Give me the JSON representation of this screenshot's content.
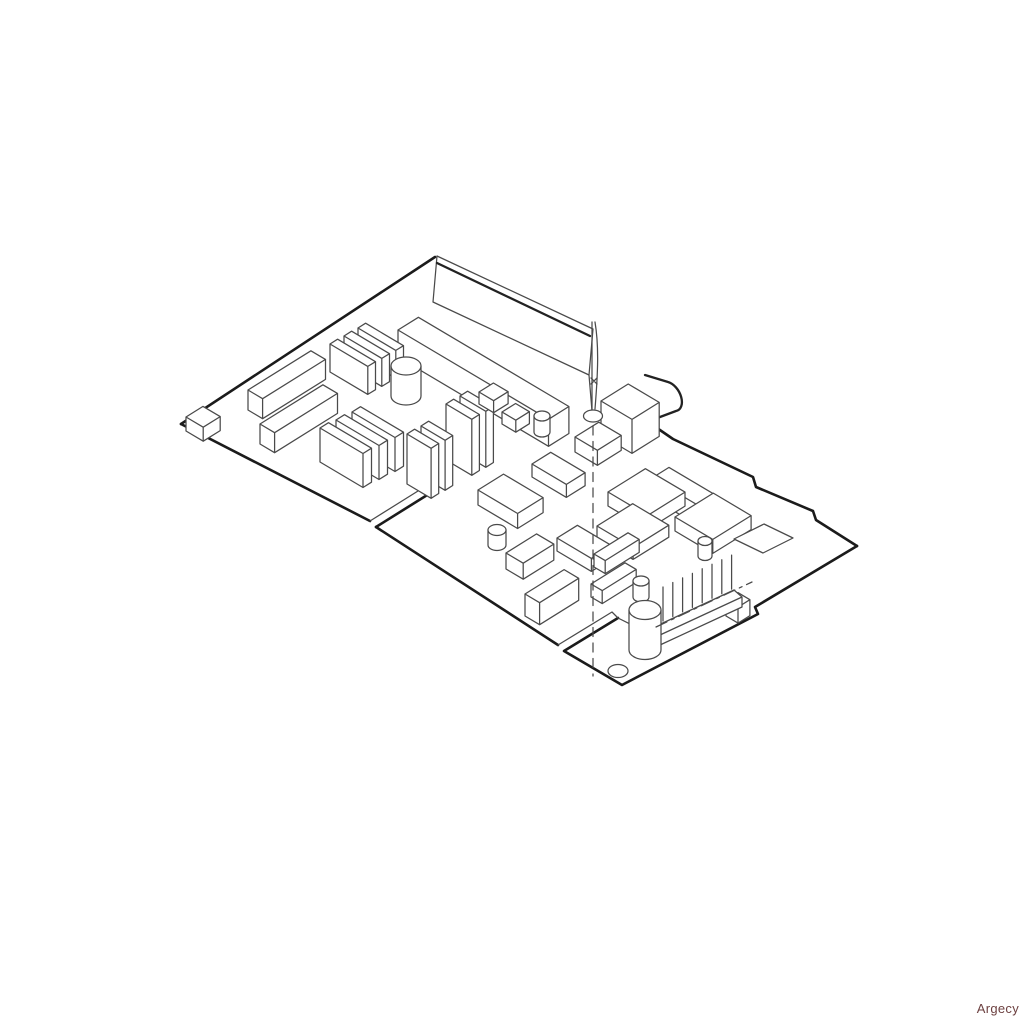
{
  "page": {
    "background": "#ffffff"
  },
  "watermark": {
    "text": "Argecy",
    "color": "#6d4141"
  },
  "diagram": {
    "description": "isometric-line-drawing-of-printer-controller-board",
    "stroke": {
      "bold": "#1b1b1b",
      "medium": "#222222",
      "thin": "#4a4a4a",
      "bold_width": 2.6,
      "medium_width": 2.3,
      "thin_width": 1.25
    },
    "fill": "#ffffff",
    "iso_axes": {
      "a": [
        0.85,
        -0.53
      ],
      "b": [
        0.86,
        0.51
      ]
    },
    "elements": [
      {
        "t": "p",
        "n": "bracket-plate",
        "d": "M437,256 L593,329 L589,375 L433,302 Z",
        "w": "T",
        "f": "W"
      },
      {
        "t": "p",
        "n": "bracket-plate-fold-edge",
        "d": "M437,263 L590,336",
        "w": "M",
        "f": "N"
      },
      {
        "t": "l",
        "n": "bracket-plate-right-edge",
        "x1": 589,
        "y1": 375,
        "x2": 592,
        "y2": 411,
        "w": "T"
      },
      {
        "t": "b",
        "n": "rear-connector",
        "x": 398,
        "y": 330,
        "la": 24,
        "lb": 175,
        "h": 27
      },
      {
        "t": "p",
        "n": "board-edge-top-left",
        "d": "M181,424 L435,257",
        "w": "B",
        "f": "N"
      },
      {
        "t": "p",
        "n": "board-edge-top-right",
        "d": "M657,428 L673,439 L753,477 L756,487 L813,511 L816,520 L857,546",
        "w": "B",
        "f": "N"
      },
      {
        "t": "p",
        "n": "board-edge-bottom-right-and-tab",
        "d": "M857,546 L755,607 L758,614 L622,685 L564,651 L618,618",
        "w": "B",
        "f": "N"
      },
      {
        "t": "p",
        "n": "board-edge-bottom-left-a",
        "d": "M181,424 L370,521",
        "w": "B",
        "f": "N"
      },
      {
        "t": "p",
        "n": "slot1-inner-edge",
        "d": "M370,521 L426,486 L432,492",
        "w": "T",
        "f": "N"
      },
      {
        "t": "p",
        "n": "slot1-outer-edge",
        "d": "M376,527 L432,492",
        "w": "B",
        "f": "N"
      },
      {
        "t": "p",
        "n": "board-edge-bottom-left-b",
        "d": "M376,527 L558,645",
        "w": "B",
        "f": "N"
      },
      {
        "t": "p",
        "n": "slot2-inner-edge",
        "d": "M558,645 L612,612 L618,618",
        "w": "T",
        "f": "N"
      },
      {
        "t": "p",
        "n": "board-inner-edge",
        "d": "M618,618 L650,634",
        "w": "T",
        "f": "N"
      },
      {
        "t": "b",
        "n": "corner-chip",
        "x": 186,
        "y": 417,
        "la": 20,
        "lb": 20,
        "h": 14
      },
      {
        "t": "b",
        "n": "ic-soic-1",
        "x": 248,
        "y": 390,
        "la": 74,
        "lb": 17,
        "h": 20
      },
      {
        "t": "b",
        "n": "ic-soic-2",
        "x": 260,
        "y": 424,
        "la": 74,
        "lb": 17,
        "h": 20
      },
      {
        "t": "b",
        "n": "module-plate-3",
        "x": 358,
        "y": 328,
        "la": 9,
        "lb": 44,
        "h": 28
      },
      {
        "t": "b",
        "n": "module-plate-2",
        "x": 344,
        "y": 336,
        "la": 9,
        "lb": 44,
        "h": 28
      },
      {
        "t": "b",
        "n": "module-plate-1",
        "x": 330,
        "y": 344,
        "la": 9,
        "lb": 44,
        "h": 28
      },
      {
        "t": "c",
        "n": "capacitor-1",
        "cx": 406,
        "cy": 366,
        "rx": 15,
        "ry": 9,
        "h": 30
      },
      {
        "t": "b",
        "n": "module-plate-6",
        "x": 352,
        "y": 412,
        "la": 10,
        "lb": 50,
        "h": 34
      },
      {
        "t": "b",
        "n": "module-plate-5",
        "x": 336,
        "y": 420,
        "la": 10,
        "lb": 50,
        "h": 34
      },
      {
        "t": "b",
        "n": "module-plate-4",
        "x": 320,
        "y": 428,
        "la": 10,
        "lb": 50,
        "h": 34
      },
      {
        "t": "b",
        "n": "vert-module-4",
        "x": 460,
        "y": 396,
        "la": 9,
        "lb": 30,
        "h": 56
      },
      {
        "t": "b",
        "n": "vert-module-3",
        "x": 446,
        "y": 404,
        "la": 9,
        "lb": 30,
        "h": 56
      },
      {
        "t": "b",
        "n": "chip-cube-2",
        "x": 479,
        "y": 392,
        "la": 17,
        "lb": 17,
        "h": 12
      },
      {
        "t": "b",
        "n": "vert-module-2",
        "x": 421,
        "y": 426,
        "la": 9,
        "lb": 28,
        "h": 50
      },
      {
        "t": "b",
        "n": "vert-module-1",
        "x": 407,
        "y": 434,
        "la": 9,
        "lb": 28,
        "h": 50
      },
      {
        "t": "b",
        "n": "chip-cube-3",
        "x": 502,
        "y": 412,
        "la": 16,
        "lb": 16,
        "h": 12
      },
      {
        "t": "c",
        "n": "capacitor-2",
        "cx": 542,
        "cy": 416,
        "rx": 8,
        "ry": 5,
        "h": 16
      },
      {
        "t": "p",
        "n": "power-jack-barrel",
        "d": "M645,375 L668,382 A10,16 -30 0 1 676,411 L652,420",
        "w": "M",
        "f": "W"
      },
      {
        "t": "b",
        "n": "power-jack-body",
        "x": 601,
        "y": 401,
        "la": 32,
        "lb": 36,
        "h": 34
      },
      {
        "t": "b",
        "n": "ic-chip-a",
        "x": 575,
        "y": 437,
        "la": 28,
        "lb": 26,
        "h": 15
      },
      {
        "t": "b",
        "n": "ic-chip-b",
        "x": 532,
        "y": 464,
        "la": 22,
        "lb": 40,
        "h": 13
      },
      {
        "t": "b",
        "n": "io-connector",
        "x": 652,
        "y": 478,
        "la": 20,
        "lb": 88,
        "h": 20
      },
      {
        "t": "b",
        "n": "ic-chip-g",
        "x": 608,
        "y": 492,
        "la": 44,
        "lb": 46,
        "h": 14
      },
      {
        "t": "b",
        "n": "ic-chip-i",
        "x": 675,
        "y": 517,
        "la": 45,
        "lb": 44,
        "h": 14
      },
      {
        "t": "b",
        "n": "ic-chip-h",
        "x": 597,
        "y": 526,
        "la": 42,
        "lb": 42,
        "h": 12
      },
      {
        "t": "p",
        "n": "pad-outline",
        "d": "M734,539 L764,524 L793,538 L763,553 Z",
        "w": "T",
        "f": "W"
      },
      {
        "t": "c",
        "n": "capacitor-3",
        "cx": 705,
        "cy": 541,
        "rx": 7,
        "ry": 4.5,
        "h": 15
      },
      {
        "t": "b",
        "n": "ic-chip-c",
        "x": 478,
        "y": 490,
        "la": 30,
        "lb": 46,
        "h": 15
      },
      {
        "t": "b",
        "n": "ic-chip-d",
        "x": 557,
        "y": 538,
        "la": 24,
        "lb": 40,
        "h": 13
      },
      {
        "t": "c",
        "n": "capacitor-4",
        "cx": 497,
        "cy": 530,
        "rx": 9,
        "ry": 5.5,
        "h": 15
      },
      {
        "t": "b",
        "n": "ic-box-f",
        "x": 506,
        "y": 553,
        "la": 36,
        "lb": 20,
        "h": 16
      },
      {
        "t": "b",
        "n": "ic-box-m",
        "x": 525,
        "y": 594,
        "la": 46,
        "lb": 17,
        "h": 22
      },
      {
        "t": "b",
        "n": "ic-box-j",
        "x": 594,
        "y": 554,
        "la": 40,
        "lb": 13,
        "h": 13
      },
      {
        "t": "b",
        "n": "ic-box-k",
        "x": 591,
        "y": 584,
        "la": 40,
        "lb": 13,
        "h": 13
      },
      {
        "t": "c",
        "n": "capacitor-5",
        "cx": 641,
        "cy": 581,
        "rx": 8,
        "ry": 5,
        "h": 16
      },
      {
        "t": "b",
        "n": "header-end-block",
        "x": 726,
        "y": 600,
        "la": 14,
        "lb": 14,
        "h": 16
      },
      {
        "t": "pins",
        "n": "header-pins",
        "x": 663,
        "y": 621,
        "dx": 9.8,
        "dy": -4.55,
        "nn": 8,
        "len": 34
      },
      {
        "t": "p",
        "n": "header-base",
        "d": "M652,628 L734,590 L742,597 L742,607 L660,645 L652,637 Z M660,635 L742,597",
        "w": "T",
        "f": "W"
      },
      {
        "t": "c",
        "n": "capacitor-big",
        "cx": 645,
        "cy": 610,
        "rx": 16,
        "ry": 9.5,
        "h": 40
      },
      {
        "t": "l",
        "n": "header-centerline",
        "x1": 656,
        "y1": 627,
        "x2": 752,
        "y2": 582,
        "w": "T",
        "da": "12 5 3 5"
      },
      {
        "t": "l",
        "n": "screw-shaft-left",
        "x1": 592,
        "y1": 322,
        "x2": 592,
        "y2": 411,
        "w": "T"
      },
      {
        "t": "p",
        "n": "screw-shaft-right",
        "d": "M595,322 C599,346 598,372 595,409",
        "w": "T",
        "f": "N"
      },
      {
        "t": "p",
        "n": "screw-tip-mark",
        "d": "M591,378 L597,384 M597,378 L591,384",
        "w": "T",
        "f": "N"
      },
      {
        "t": "e",
        "n": "standoff-hole",
        "cx": 593,
        "cy": 416,
        "rx": 9.5,
        "ry": 6
      },
      {
        "t": "e",
        "n": "mounting-hole",
        "cx": 618,
        "cy": 671,
        "rx": 10,
        "ry": 6.5
      },
      {
        "t": "l",
        "n": "screw-centerline",
        "x1": 593,
        "y1": 426,
        "x2": 593,
        "y2": 676,
        "w": "T",
        "da": "9 6.5"
      }
    ]
  }
}
